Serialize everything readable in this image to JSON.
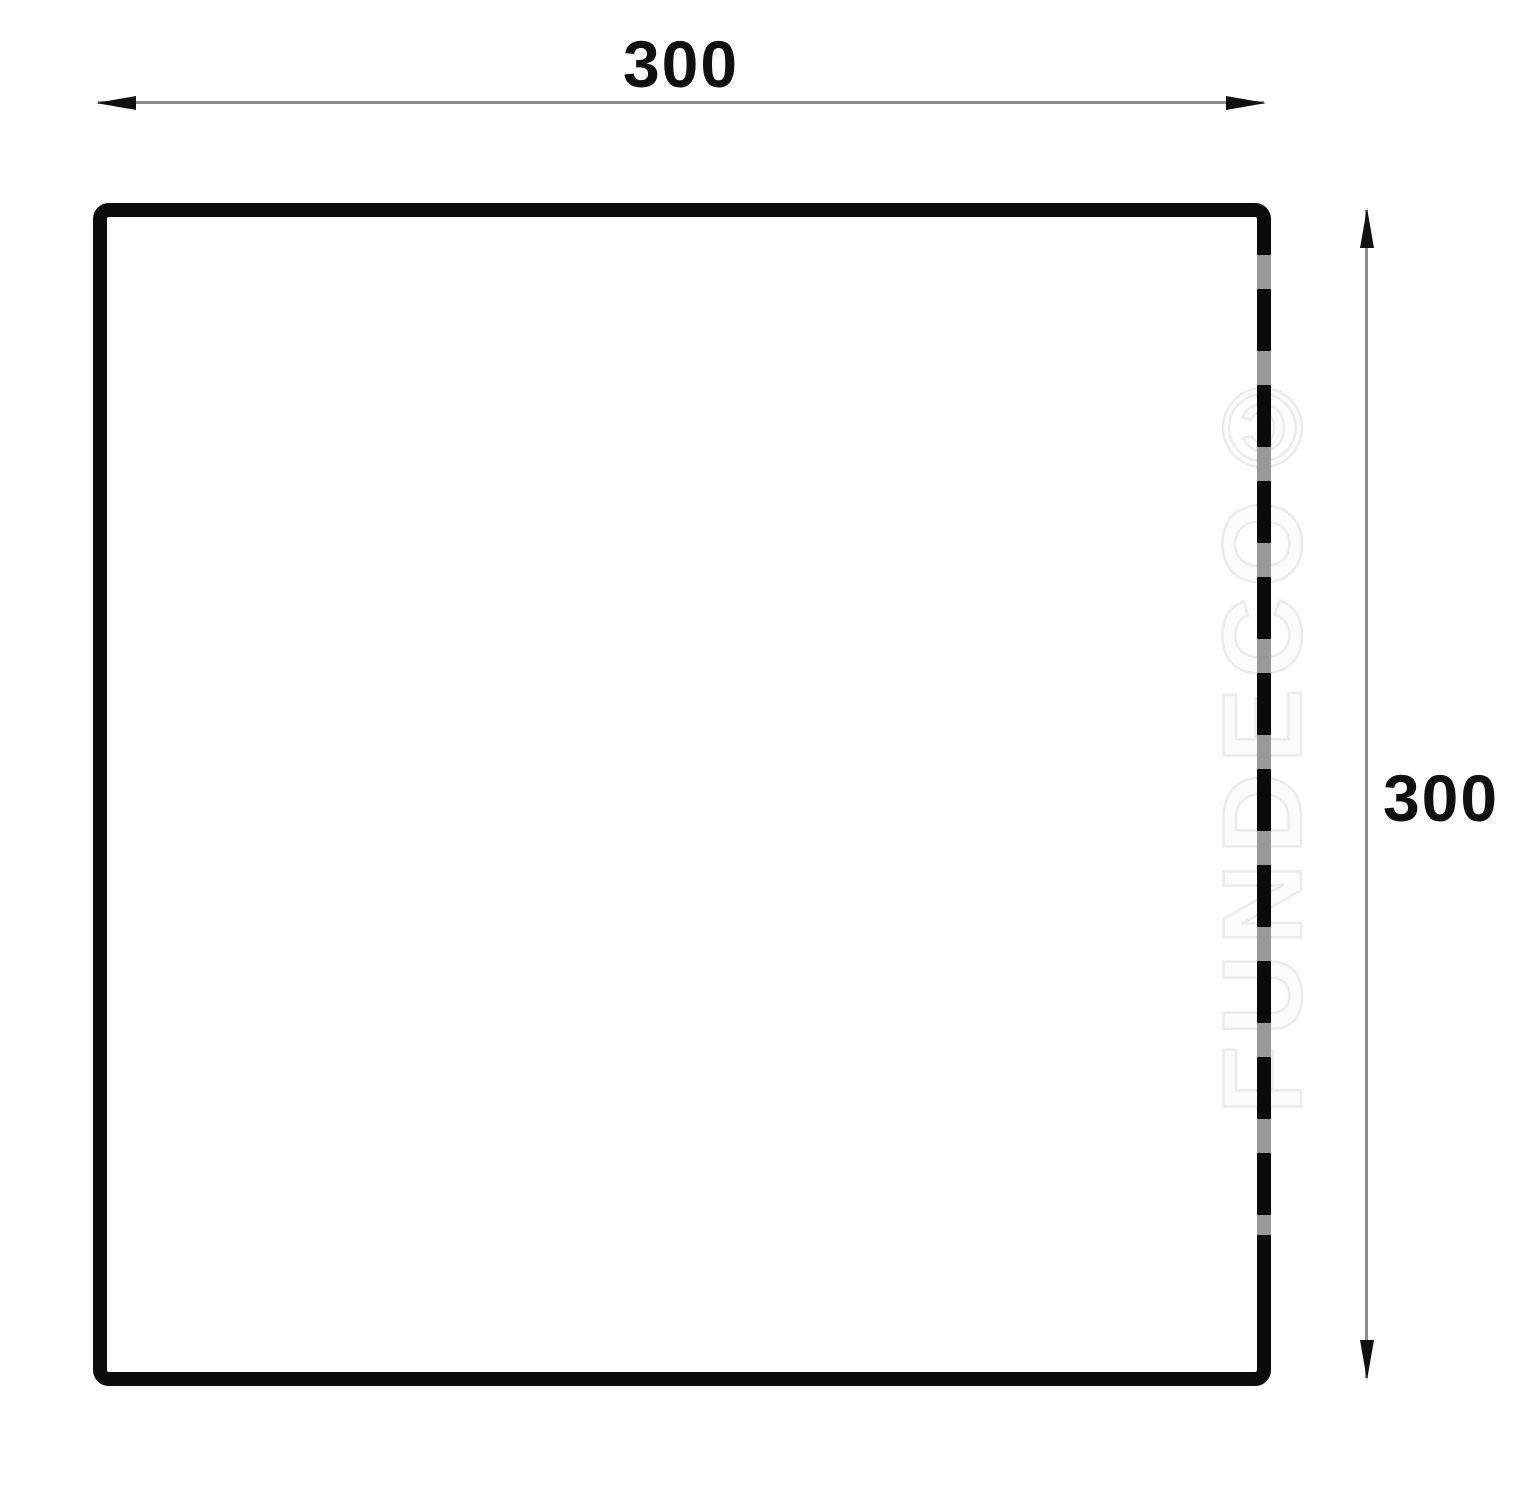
{
  "drawing": {
    "shape": "square",
    "top_dimension": {
      "label": "300"
    },
    "right_dimension": {
      "label": "300"
    },
    "watermark": {
      "text": "FUNDECO©"
    },
    "colors": {
      "background": "#ffffff",
      "outline": "#0b0b0b",
      "dim-line": "#8c8c8c",
      "arrow": "#111111",
      "label": "#101010",
      "watermark": "#ebebeb"
    }
  }
}
